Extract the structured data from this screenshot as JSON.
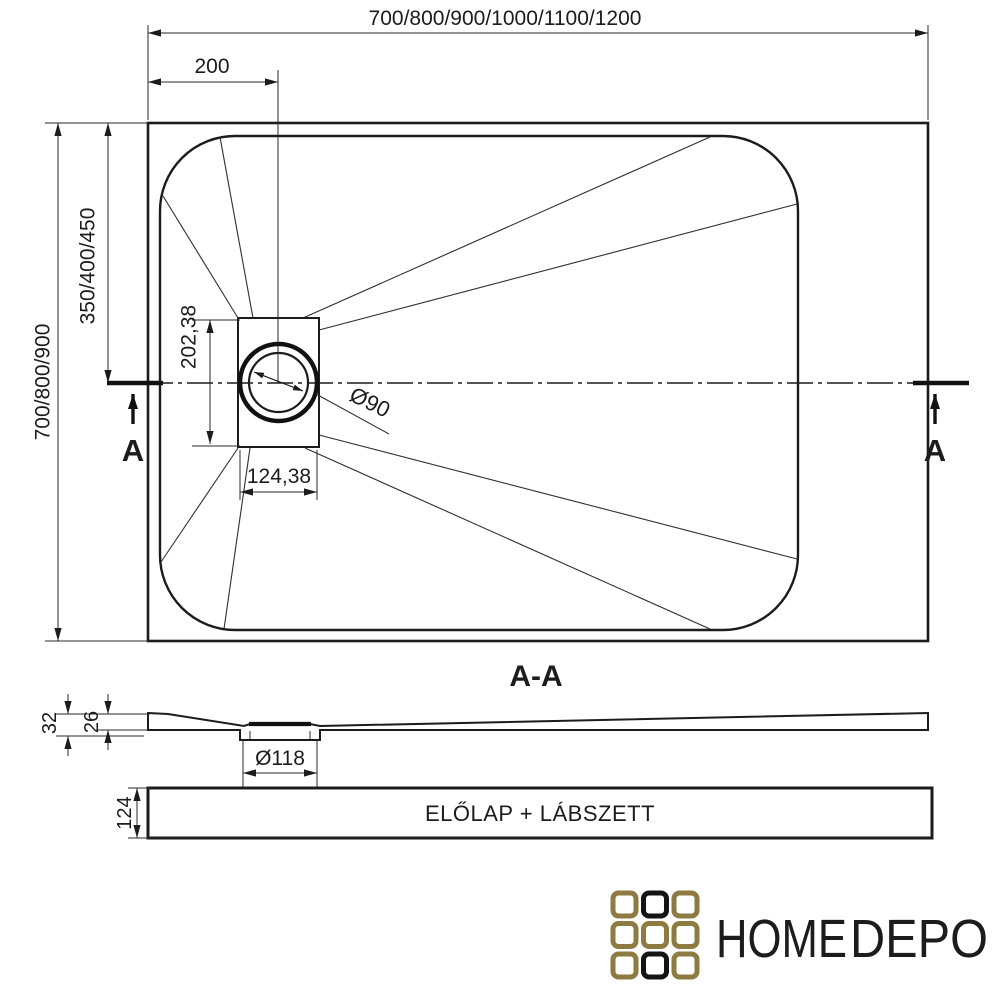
{
  "drawing": {
    "top_view": {
      "overall_width": "700/800/900/1000/1100/1200",
      "drain_offset_x": "200",
      "overall_depth": "700/800/900",
      "drain_offset_y": "350/400/450",
      "recess_height": "202,38",
      "recess_width": "124,38",
      "drain_diameter": "Ø90",
      "section_marker": "A"
    },
    "section_view": {
      "title": "A-A",
      "total_thickness": "32",
      "edge_thickness": "26",
      "drain_hole_diameter": "Ø118"
    },
    "front_panel": {
      "label": "ELŐLAP + LÁBSZETT",
      "height": "124"
    },
    "logo": {
      "word_primary": "HOME",
      "word_secondary": "DEPO"
    },
    "colors": {
      "ink": "#1c1c1c",
      "gold": "#8d7b41"
    }
  }
}
